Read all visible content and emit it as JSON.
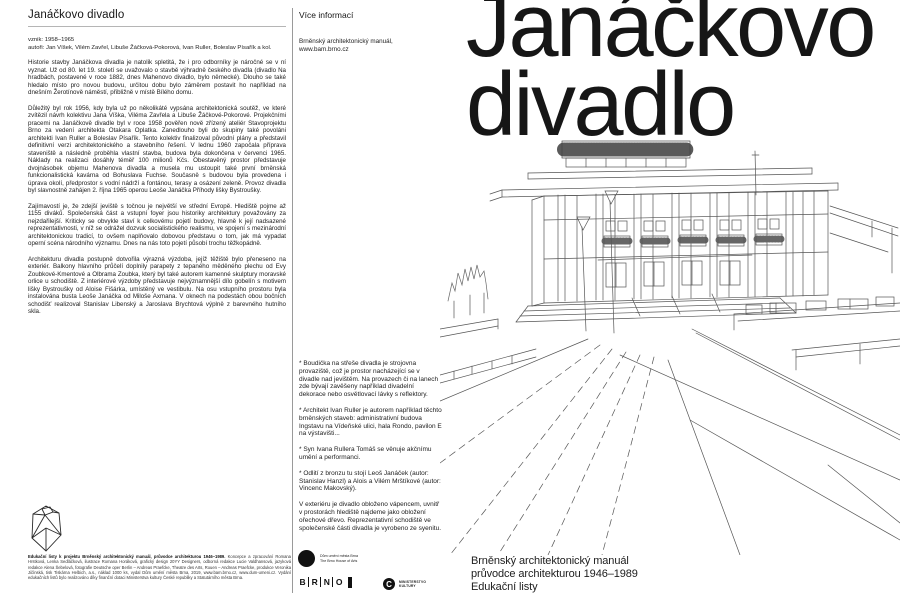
{
  "colors": {
    "ink": "#161616",
    "line_art": "#555555",
    "divider": "#9a9a9a"
  },
  "left": {
    "title": "Janáčkovo divadlo",
    "meta1": "vznik: 1958–1965",
    "meta2": "autoři: Jan Víšek, Vilém Zavřel, Libuše Žáčková-Pokorová, Ivan Ruller, Boleslav Písařík a kol.",
    "paragraphs": [
      "Historie stavby Janáčkova divadla je natolik spletitá, že i pro odborníky je náročné se v ní vyznat. Už od 80. let 19. století se uvažovalo o stavbě výhradně českého divadla (divadlo Na hradbách, postavené v roce 1882, dnes Mahenovo divadlo, bylo německé). Dlouho se také hledalo místo pro novou budovu, určitou dobu bylo záměrem postavit ho například na dnešním Žerotínově náměstí, přibližně v místě Bílého domu.",
      "Důležitý byl rok 1956, kdy byla už po několikáté vypsána architektonická soutěž, ve které zvítězil návrh kolektivu Jana Víška, Viléma Zavřela a Libuše Žáčkové-Pokorové. Projekčními pracemi na Janáčkově divadle byl v roce 1958 pověřen nově zřízený ateliér Stavoprojektu Brno za vedení architekta Otakara Oplatka. Zanedlouho byli do skupiny také povoláni architekti Ivan Ruller a Boleslav Písařík. Tento kolektiv finalizoval původní plány a představil definitivní verzi architektonického a stavebního řešení. V lednu 1960 započala příprava staveniště a následně proběhla vlastní stavba, budova byla dokončena v červenci 1965. Náklady na realizaci dosáhly téměř 100 milionů Kčs. Obestavěný prostor představuje dvojnásobek objemu Mahenova divadla a musela mu ustoupit také první brněnská funkcionalistická kavárna od Bohuslava Fuchse. Současně s budovou byla provedena i úprava okolí, předprostor s vodní nádrží a fontánou, terasy a osázení zeleně. Provoz divadla byl slavnostně zahájen 2. října 1965 operou Leoše Janáčka Příhody lišky Bystroušky.",
      "Zajímavostí je, že zdejší jeviště s točnou je největší ve střední Evropě. Hlediště pojme až 1155 diváků. Společenská část a vstupní foyer jsou historiky architektury považovány za nejzdařilejší. Kriticky se obvykle staví k celkovému pojetí budovy, hlavně k její nadsazené reprezentativnosti, v níž se odrážel dozvuk socialistického realismu, ve spojení s mezinárodní architektonickou tradicí, to ovšem naplňovalo dobovou představu o tom, jak má vypadat operní scéna národního významu. Dnes na nás toto pojetí působí trochu těžkopádně.",
      "Architekturu divadla postupně dotvořila výrazná výzdoba, jejíž těžiště bylo přeneseno na exteriér. Balkony hlavního průčelí doplnily parapety z tepaného měděného plechu od Evy Zoubkové-Kmentové a Olbrama Zoubka, který byl také autorem kamenné skulptury moravské orlice u schodiště. Z interiérové výzdoby představuje nejvýznamnější dílo gobelín s motivem lišky Bystroušky od Aloise Fišárka, umístěný ve vestibulu. Na osu vstupního prostoru byla instalována busta Leoše Janáčka od Miloše Axmana. V oknech na podestách obou bočních schodišť realizoval Stanislav Libenský a Jaroslava Brychtová výplně z barevného hutního skla."
    ],
    "imprint_title": "Edukační listy k projektu Brněnský architektonický manuál, průvodce architekturou 1946–1989.",
    "imprint_body": " Koncepce a zpracování Romana Hrstková, Lenka Sedláčková, ilustrace Romana Horáková, grafický design 20YY Designers, odborná redakce Lucie Valdhansová, jazyková redakce Alena Šebelová, fotografie Deutsche oper Berlin – Andreas Praefcke, Theatre des Arts, Rouen – Andreas Praefcke, produkce Veronika Jičínská, tisk Tiskárna Helbich, a.s., náklad 1000 ks, vydal Dům umění města Brna, 2019, www.bam.brno.cz, www.dum-umeni.cz. Vydání edukačních listů bylo realizováno díky finanční dotaci Ministerstva kultury České republiky a Statutárního města Brna."
  },
  "middle": {
    "header": "Více informací",
    "source1": "Brněnský architektonický manuál,",
    "source2": "www.bam.brno.cz",
    "notes": [
      "* Boudička na střeše divadla je strojovna provaziště, což je prostor nacházející se v divadle nad jevištěm. Na provazech či na lanech zde bývají zavěšeny například divadelní dekorace nebo osvětlovací lávky s reflektory.",
      "* Architekt Ivan Ruller je autorem například těchto brněnských staveb: administrativní budova Ingstavu na Vídeňské ulici, hala Rondo, pavilon E na výstavišti...",
      "* Syn Ivana Rullera Tomáš se věnuje akčnímu umění a performanci.",
      "* Odlití z bronzu tu stojí Leoš Janáček (autor: Stanislav Hanzl) a Alois a Vilém Mrštíkové (autor: Vincenc Makovský).",
      "V exteriéru je divadlo obloženo vápencem, uvnitř v prostorách hlediště najdeme jako obložení ořechové dřevo. Reprezentativní schodiště ve společenské části divadla je vyrobeno ze syenitu."
    ],
    "logo_dum1": "Dům umění města Brna",
    "logo_dum2": "The Brno House of Arts",
    "logo_brno": [
      "B",
      "R",
      "N",
      "O"
    ],
    "logo_ministry_c": "C",
    "logo_ministry1": "MINISTERSTVO",
    "logo_ministry2": "KULTURY"
  },
  "right": {
    "title1": "Janáčkovo",
    "title2": "divadlo",
    "footer1": "Brněnský architektonický manuál",
    "footer2": "průvodce architekturou 1946–1989",
    "footer3": "Edukační listy"
  }
}
